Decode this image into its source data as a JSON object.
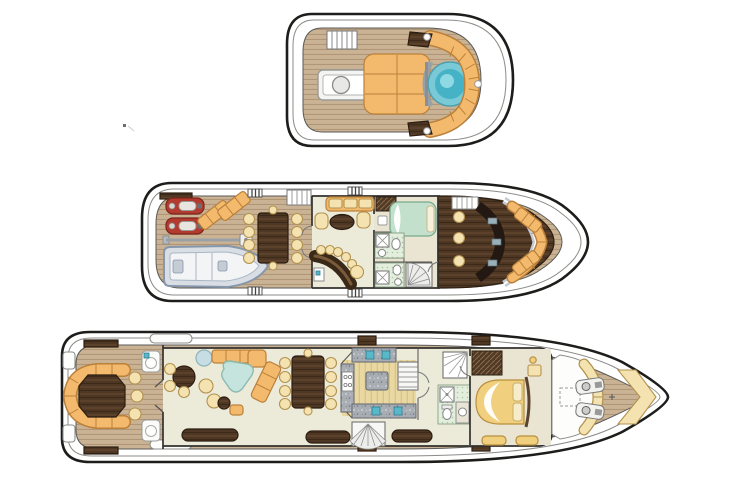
{
  "diagram": {
    "type": "yacht-deck-plan",
    "view": "top-down general arrangement, three decks",
    "decks": [
      {
        "id": "sun-deck",
        "features": [
          "companionway-stairs-icon",
          "wet-bar-icon",
          "sunpad-icon",
          "jacuzzi-icon",
          "curved-bench-icon",
          "corner-table-icon",
          "drink-holder-icon"
        ]
      },
      {
        "id": "bridge-deck",
        "features": [
          "jet-ski-icon",
          "jet-ski-icon",
          "sun-lounger-icon",
          "sun-lounger-icon",
          "tender-crane-icon",
          "tender-boat-icon",
          "alfresco-dining-table-icon",
          "dining-chair-icon",
          "deck-stairs-icon",
          "skylounge-sofa-icon",
          "armchair-icon",
          "coffee-table-icon",
          "bar-counter-icon",
          "bar-stool-icon",
          "captain-cabin-bed-icon",
          "wardrobe-icon",
          "shower-icon",
          "toilet-icon",
          "sink-icon",
          "spiral-staircase-icon",
          "helm-console-icon",
          "helm-chair-icon",
          "windshield-icon",
          "bow-settee-icon",
          "deck-cleat-icon"
        ]
      },
      {
        "id": "main-deck",
        "features": [
          "swim-platform-icon",
          "aft-dining-table-icon",
          "curved-bench-icon",
          "dining-chair-icon",
          "planter-table-icon",
          "game-table-icon",
          "side-table-icon",
          "l-sofa-icon",
          "glass-coffee-table-icon",
          "armchair-icon",
          "ottoman-icon",
          "sideboard-icon",
          "formal-dining-table-icon",
          "galley-counter-icon",
          "galley-island-icon",
          "stove-icon",
          "sink-icon",
          "staircase-icon",
          "spiral-staircase-icon",
          "day-head-icon",
          "shower-icon",
          "toilet-icon",
          "wardrobe-icon",
          "master-bed-icon",
          "nightstand-icon",
          "vanity-bench-icon",
          "windshield-brow-icon",
          "skylight-icon",
          "anchor-windlass-icon",
          "bow-v-seat-icon",
          "deck-cleat-icon",
          "boarding-recess-icon"
        ]
      }
    ]
  },
  "colors": {
    "hull-line": "#1d1d1b",
    "inner-line": "#8b8b89",
    "teak": "#c9b394",
    "teak-line": "#ab9172",
    "cushion-orange": "#f3ba6d",
    "cushion-orange-edge": "#bb803a",
    "cushion-cream": "#f4e2b0",
    "cushion-cream-edge": "#b3924f",
    "dark-wood": "#4e3725",
    "jacuzzi-rim": "#79c9d6",
    "jacuzzi-water": "#46b2c5",
    "bed-green": "#c2e0cc",
    "bed-gold": "#f0cf7e",
    "jetski-red": "#b23a2e",
    "tender-grey": "#d9dee5",
    "tender-edge": "#8696ab",
    "granite": "#a8adb4",
    "galley-floor": "#ead8a2",
    "tile-green": "#e3eedd",
    "salon-floor": "#ecead9",
    "metal-silver": "#c3c9d1",
    "fixture-teal": "#58b7c9"
  }
}
